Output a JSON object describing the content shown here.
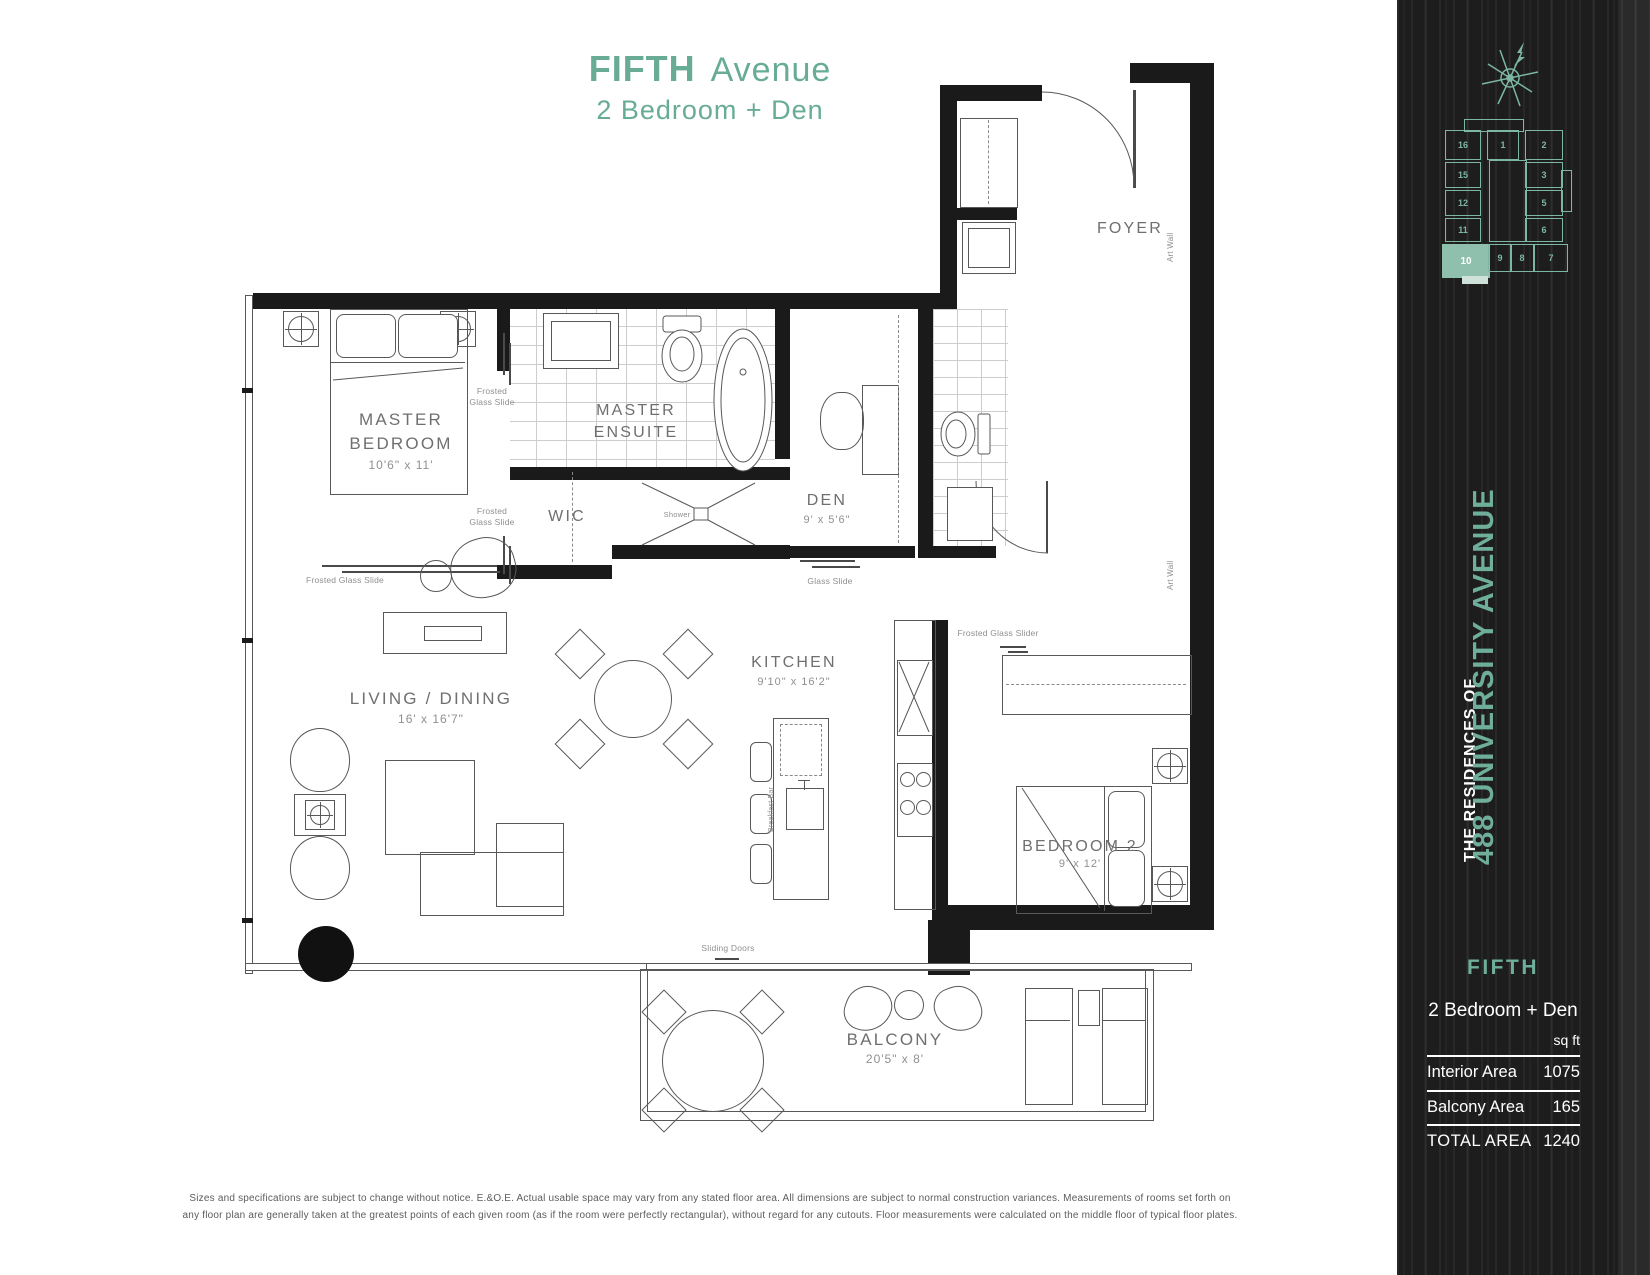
{
  "title": {
    "main": "FIFTH",
    "suffix": "Avenue",
    "subtitle": "2 Bedroom + Den"
  },
  "plan": {
    "rooms": [
      {
        "label": "MASTER BEDROOM",
        "dims": "10'6\" x 11'"
      },
      {
        "label": "MASTER ENSUITE",
        "dims": ""
      },
      {
        "label": "WIC",
        "dims": ""
      },
      {
        "label": "Shower",
        "dims": ""
      },
      {
        "label": "DEN",
        "dims": "9' x 5'6\""
      },
      {
        "label": "FOYER",
        "dims": ""
      },
      {
        "label": "KITCHEN",
        "dims": "9'10\" x 16'2\""
      },
      {
        "label": "LIVING / DINING",
        "dims": "16' x 16'7\""
      },
      {
        "label": "BEDROOM 2",
        "dims": "9' x 12'"
      },
      {
        "label": "BALCONY",
        "dims": "20'5\" x 8'"
      }
    ],
    "annotations": {
      "frosted_glass_slide": "Frosted Glass Slide",
      "frosted_glass_slider": "Frosted Glass Slider",
      "glass_slide": "Glass Slide",
      "sliding_doors": "Sliding Doors",
      "art_wall": "Art Wall",
      "breakfast_bar": "Breakfast Bar"
    }
  },
  "sidebar": {
    "residences": "THE RESIDENCES OF",
    "address": "488 UNIVERSITY AVENUE",
    "plan_name": "FIFTH",
    "plan_type": "2 Bedroom + Den",
    "unit": "sq ft",
    "areas": [
      {
        "label": "Interior Area",
        "value": "1075"
      },
      {
        "label": "Balcony Area",
        "value": "165"
      },
      {
        "label": "TOTAL AREA",
        "value": "1240"
      }
    ],
    "keyplan": {
      "units": [
        "16",
        "1",
        "2",
        "15",
        "3",
        "12",
        "5",
        "11",
        "6",
        "10",
        "9",
        "8",
        "7"
      ],
      "highlighted": "10"
    }
  },
  "disclaimer": {
    "line1": "Sizes and specifications are subject to change without notice. E.&O.E. Actual usable space may vary from any stated floor area. All dimensions are subject to normal construction variances. Measurements of rooms set forth on",
    "line2": "any floor plan are generally taken at the greatest points of each given room (as if the room were perfectly rectangular), without regard for any cutouts. Floor measurements were calculated on the middle floor of typical floor plates."
  },
  "colors": {
    "accent": "#68AC96",
    "keyplan_line": "#7DB6A3",
    "highlight_fill": "#8FBFAD",
    "sidebar_bg": "#1C1D1C"
  }
}
